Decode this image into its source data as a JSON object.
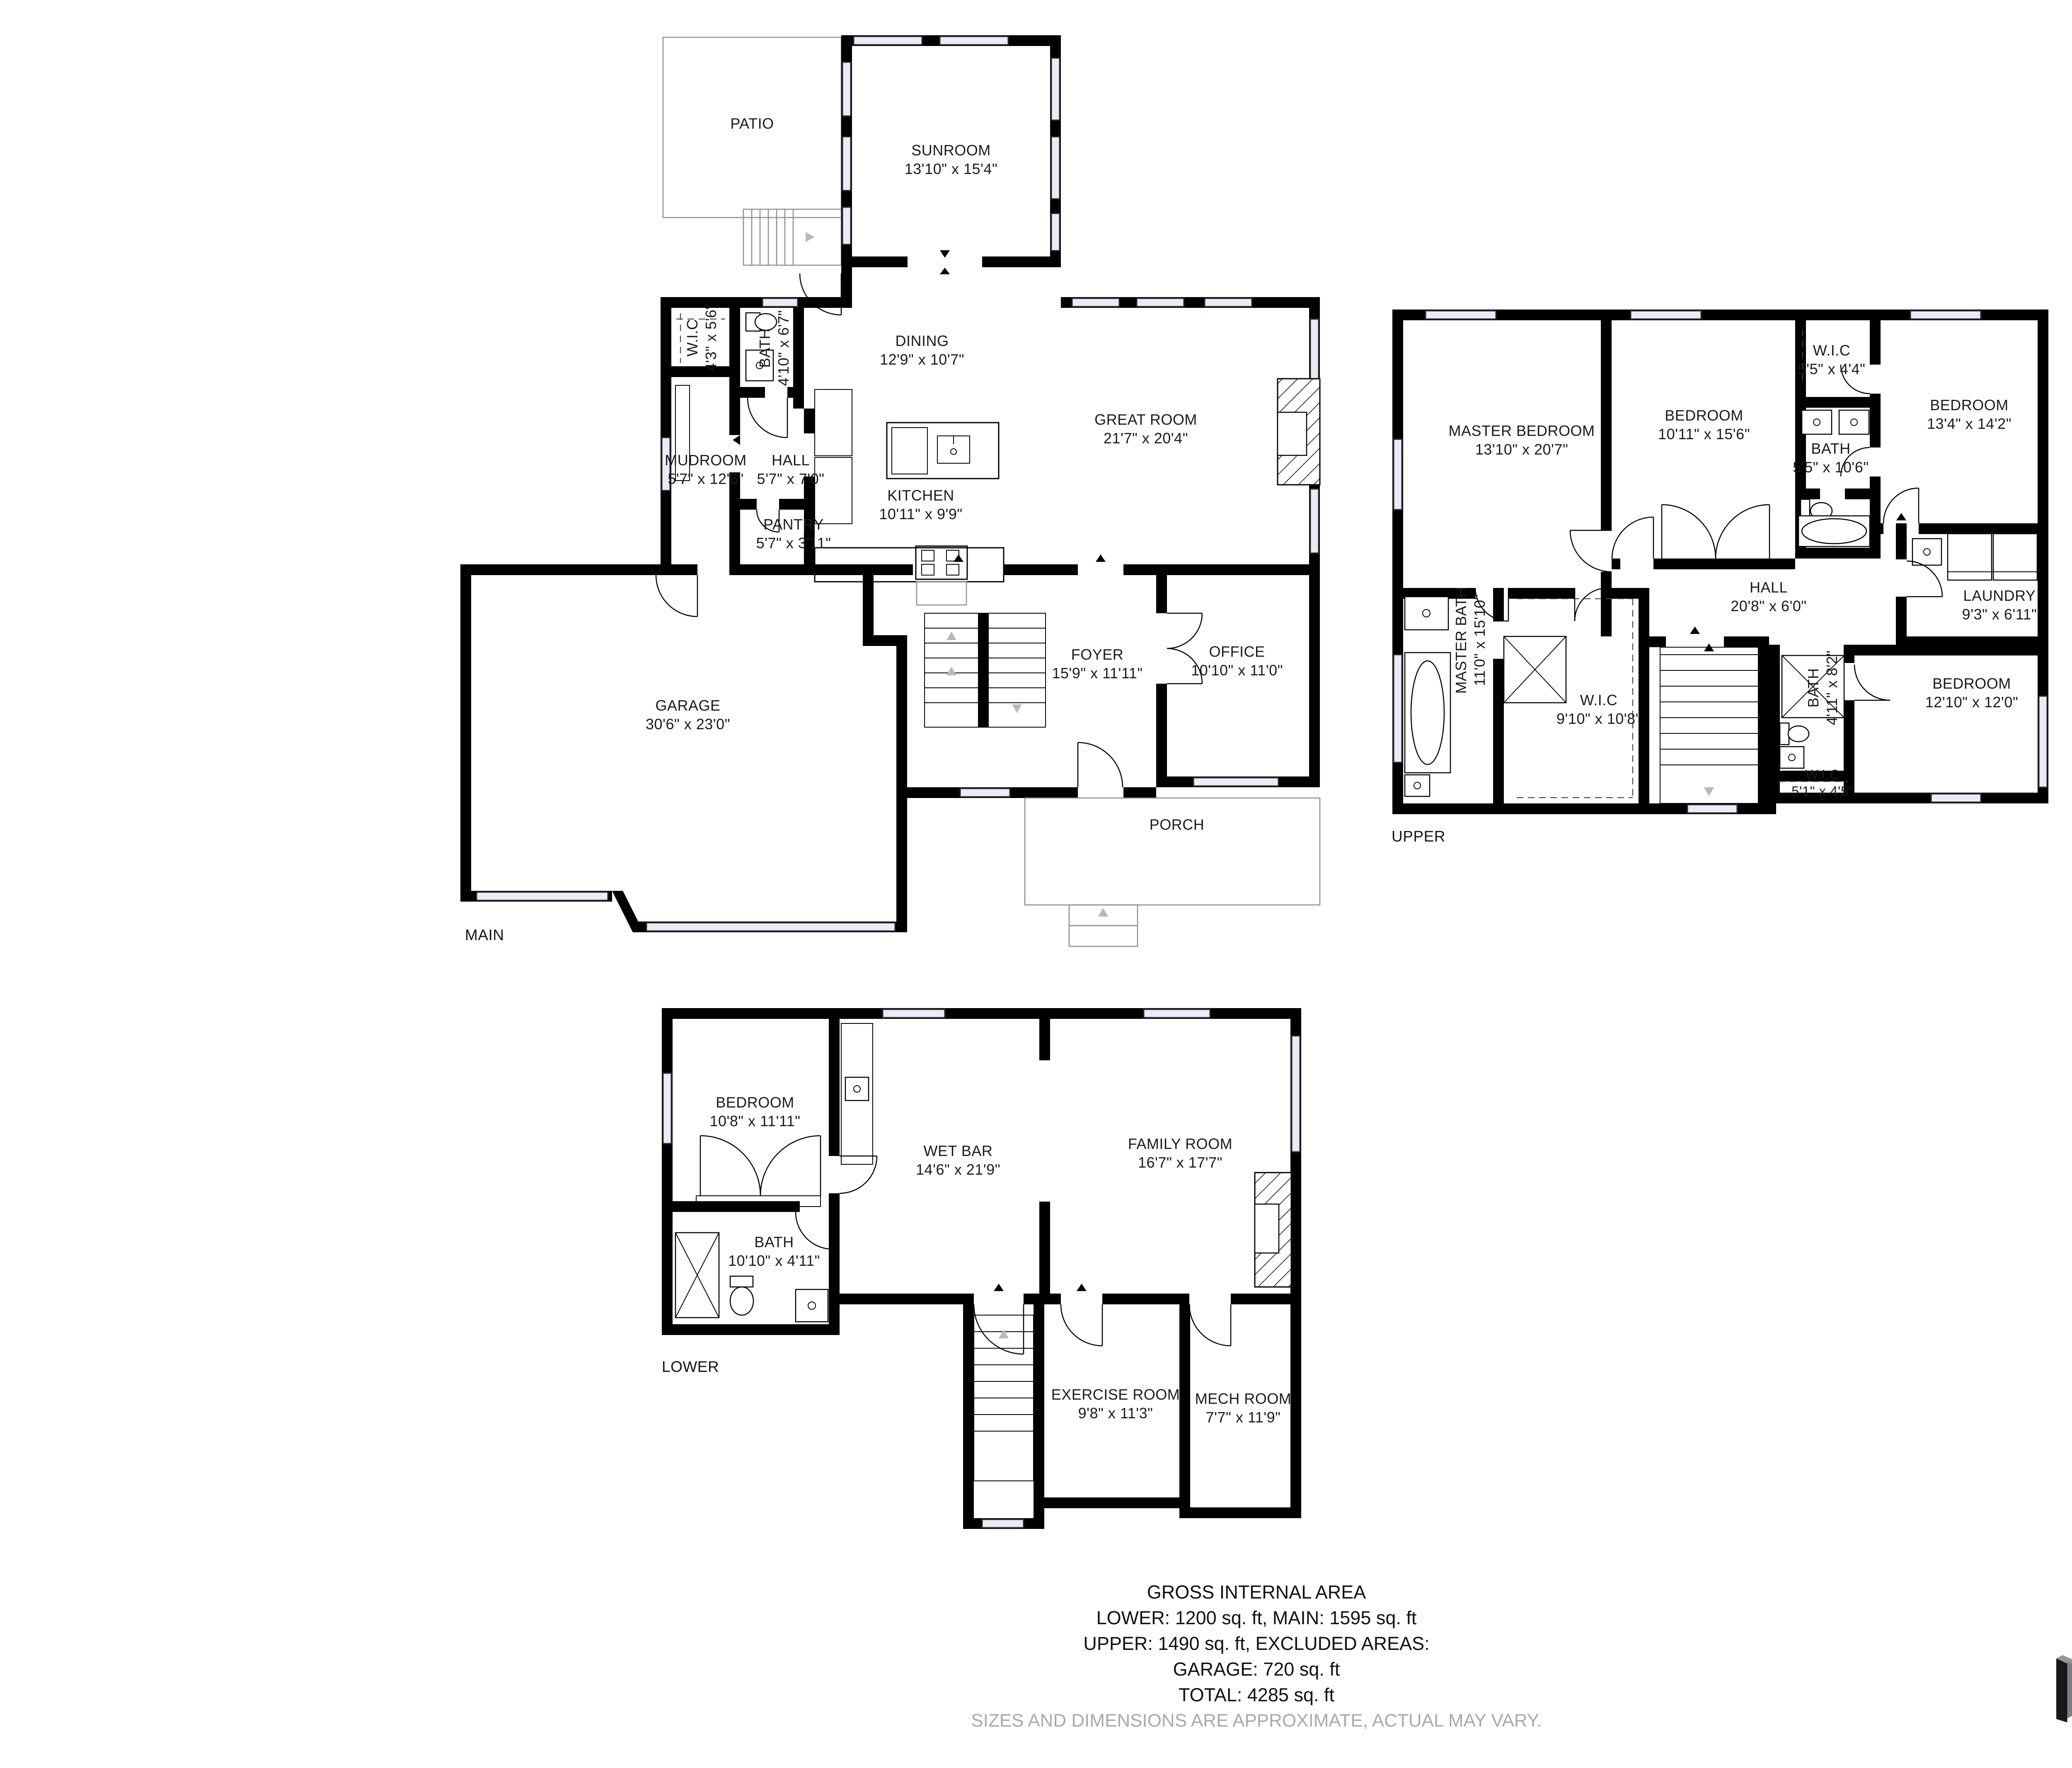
{
  "page": {
    "background": "#ffffff",
    "type": "matterport-floor-plan"
  },
  "floors": {
    "main": {
      "tag": "MAIN",
      "rooms": [
        {
          "name": "PATIO",
          "dims": ""
        },
        {
          "name": "SUNROOM",
          "dims": "13'10\" x 15'4\""
        },
        {
          "name": "DINING",
          "dims": "12'9\" x 10'7\""
        },
        {
          "name": "GREAT ROOM",
          "dims": "21'7\" x 20'4\""
        },
        {
          "name": "W.I.C",
          "dims": "4'3\" x 5'6\""
        },
        {
          "name": "BATH",
          "dims": "4'10\" x 6'7\""
        },
        {
          "name": "MUDROOM",
          "dims": "5'7\" x 12'6\""
        },
        {
          "name": "HALL",
          "dims": "5'7\" x 7'0\""
        },
        {
          "name": "KITCHEN",
          "dims": "10'11\" x 9'9\""
        },
        {
          "name": "PANTRY",
          "dims": "5'7\" x 3'11\""
        },
        {
          "name": "GARAGE",
          "dims": "30'6\" x 23'0\""
        },
        {
          "name": "FOYER",
          "dims": "15'9\" x 11'11\""
        },
        {
          "name": "OFFICE",
          "dims": "10'10\" x 11'0\""
        },
        {
          "name": "PORCH",
          "dims": ""
        }
      ]
    },
    "upper": {
      "tag": "UPPER",
      "rooms": [
        {
          "name": "MASTER BEDROOM",
          "dims": "13'10\" x 20'7\""
        },
        {
          "name": "BEDROOM",
          "dims": "10'11\" x 15'6\""
        },
        {
          "name": "W.I.C",
          "dims": "5'5\" x 4'4\""
        },
        {
          "name": "BATH",
          "dims": "5'5\" x 10'6\""
        },
        {
          "name": "BEDROOM",
          "dims": "13'4\" x 14'2\""
        },
        {
          "name": "LAUNDRY",
          "dims": "9'3\" x 6'11\""
        },
        {
          "name": "HALL",
          "dims": "20'8\" x 6'0\""
        },
        {
          "name": "MASTER BATH",
          "dims": "11'0\" x 15'10\""
        },
        {
          "name": "W.I.C",
          "dims": "9'10\" x 10'8\""
        },
        {
          "name": "BATH",
          "dims": "4'11\" x 8'2\""
        },
        {
          "name": "BEDROOM",
          "dims": "12'10\" x 12'0\""
        },
        {
          "name": "W.I.C",
          "dims": "5'1\" x 4'5\""
        }
      ]
    },
    "lower": {
      "tag": "LOWER",
      "rooms": [
        {
          "name": "BEDROOM",
          "dims": "10'8\" x 11'11\""
        },
        {
          "name": "WET BAR",
          "dims": "14'6\" x 21'9\""
        },
        {
          "name": "FAMILY ROOM",
          "dims": "16'7\" x 17'7\""
        },
        {
          "name": "BATH",
          "dims": "10'10\" x 4'11\""
        },
        {
          "name": "EXERCISE ROOM",
          "dims": "9'8\" x 11'3\""
        },
        {
          "name": "MECH ROOM",
          "dims": "7'7\" x 11'9\""
        }
      ]
    }
  },
  "summary": {
    "title": "GROSS INTERNAL AREA",
    "line1": "LOWER: 1200 sq. ft, MAIN: 1595 sq. ft",
    "line2": "UPPER: 1490 sq. ft, EXCLUDED AREAS:",
    "line3": "GARAGE: 720 sq. ft",
    "line4": "TOTAL: 4285 sq. ft",
    "disclaimer": "SIZES AND DIMENSIONS ARE APPROXIMATE, ACTUAL MAY VARY."
  },
  "brand": {
    "logo_text": "Matterport",
    "logo_icon": "matterport-m-mark"
  },
  "colors": {
    "wall": "#000000",
    "window_fill": "#e9ecf7",
    "label_text": "#1b1b1b",
    "disclaimer_text": "#a9a9a9",
    "logo_dark": "#232327",
    "logo_gray": "#97979b"
  }
}
